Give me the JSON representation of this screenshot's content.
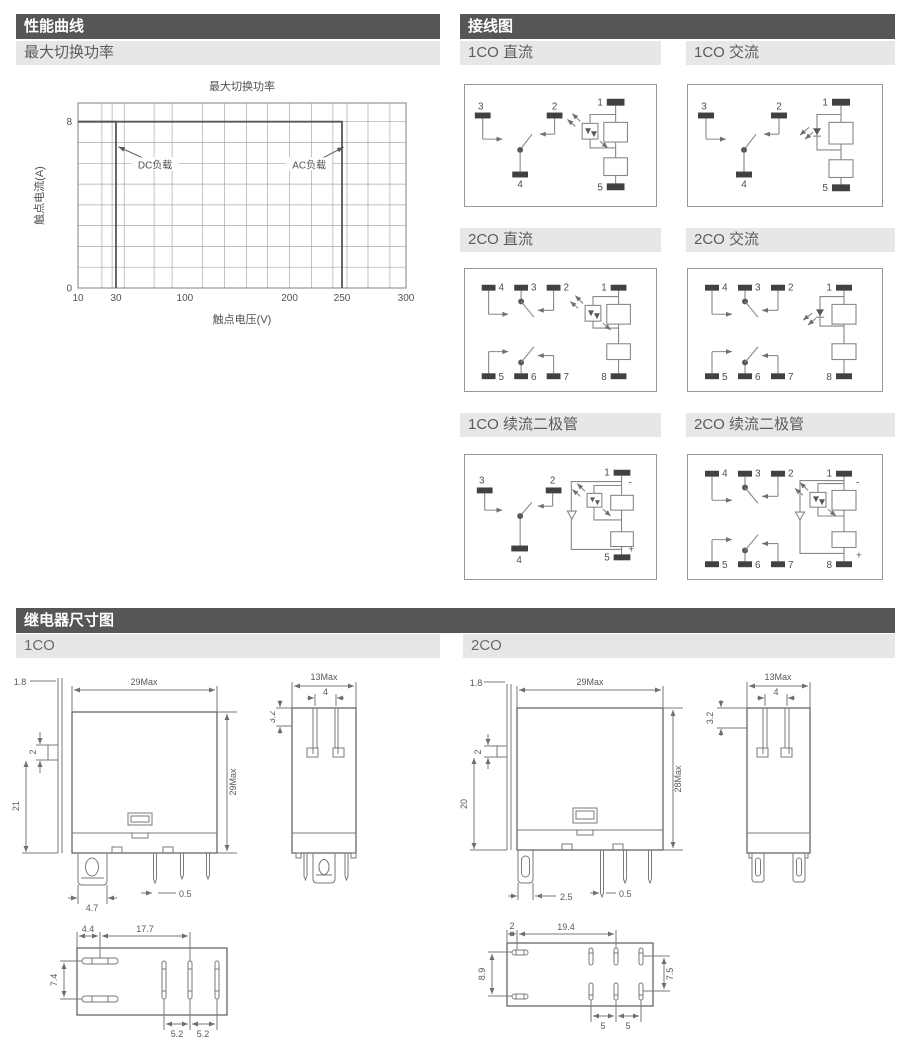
{
  "performance": {
    "header": "性能曲线",
    "subheader": "最大切换功率"
  },
  "chart_data": {
    "type": "line",
    "title": "最大切换功率",
    "xlabel": "触点电压(V)",
    "ylabel": "触点电流(A)",
    "x_ticks": [
      {
        "value": 10,
        "frac": 0
      },
      {
        "value": 30,
        "frac": 0.116
      },
      {
        "value": 100,
        "frac": 0.326
      },
      {
        "value": 200,
        "frac": 0.645
      },
      {
        "value": 250,
        "frac": 0.805
      },
      {
        "value": 300,
        "frac": 1
      }
    ],
    "x_gridline_fracs": [
      0,
      0.073,
      0.104,
      0.141,
      0.232,
      0.287,
      0.379,
      0.447,
      0.514,
      0.578,
      0.645,
      0.712,
      0.777,
      0.82,
      0.884,
      0.951,
      1
    ],
    "y_min": 0,
    "y_max": 8.9,
    "y_gridline_step": 1,
    "y_ticks": [
      0,
      8
    ],
    "grid": true,
    "series": [
      {
        "name": "DC负载",
        "points": [
          [
            10,
            8
          ],
          [
            30,
            8
          ],
          [
            30,
            0
          ]
        ]
      },
      {
        "name": "AC负载",
        "points": [
          [
            10,
            8
          ],
          [
            250,
            8
          ],
          [
            250,
            0
          ]
        ]
      }
    ],
    "annotations": [
      {
        "text": "DC负载",
        "text_frac_x": 0.235,
        "text_y": 5.9,
        "from_x": 0.205,
        "from_y": 6.2,
        "tip_x": 0.123,
        "tip_y": 6.8
      },
      {
        "text": "AC负载",
        "text_frac_x": 0.705,
        "text_y": 5.9,
        "from_x": 0.74,
        "from_y": 6.2,
        "tip_x": 0.81,
        "tip_y": 6.78
      }
    ]
  },
  "wiring": {
    "header": "接线图",
    "diagrams": [
      {
        "title": "1CO 直流",
        "terminals": {
          "t1": "1",
          "t2": "2",
          "t3": "3",
          "t4": "4",
          "t5": "5"
        }
      },
      {
        "title": "1CO 交流",
        "terminals": {
          "t1": "1",
          "t2": "2",
          "t3": "3",
          "t4": "4",
          "t5": "5"
        }
      },
      {
        "title": "2CO 直流",
        "terminals": {
          "t1": "1",
          "t2": "2",
          "t3": "3",
          "t4": "4",
          "t5": "5",
          "t6": "6",
          "t7": "7",
          "t8": "8"
        }
      },
      {
        "title": "2CO 交流",
        "terminals": {
          "t1": "1",
          "t2": "2",
          "t3": "3",
          "t4": "4",
          "t5": "5",
          "t6": "6",
          "t7": "7",
          "t8": "8"
        }
      },
      {
        "title": "1CO 续流二极管",
        "terminals": {
          "t1": "1",
          "t2": "2",
          "t3": "3",
          "t4": "4",
          "t5": "5"
        },
        "polarity": {
          "minus": "-",
          "plus": "+"
        }
      },
      {
        "title": "2CO 续流二极管",
        "terminals": {
          "t1": "1",
          "t2": "2",
          "t3": "3",
          "t4": "4",
          "t5": "5",
          "t6": "6",
          "t7": "7",
          "t8": "8"
        },
        "polarity": {
          "minus": "-",
          "plus": "+"
        }
      }
    ]
  },
  "dimensions": {
    "header": "继电器尺寸图",
    "one_co": {
      "label": "1CO",
      "front": {
        "flange": "1.8",
        "width": "29Max",
        "step": "2",
        "height_left": "21",
        "height_right": "29Max",
        "pin_wide": "4.7",
        "pin_thin": "0.5"
      },
      "side": {
        "width": "13Max",
        "prong_gap": "4",
        "notch": "3.2"
      },
      "bottom": {
        "offset": "4.4",
        "span": "17.7",
        "row_gap": "7.4",
        "pitch_a": "5.2",
        "pitch_b": "5.2"
      }
    },
    "two_co": {
      "label": "2CO",
      "front": {
        "flange": "1.8",
        "width": "29Max",
        "step": "2",
        "height_left": "20",
        "height_right": "28Max",
        "pin_wide": "2.5",
        "pin_thin": "0.5"
      },
      "side": {
        "width": "13Max",
        "prong_gap": "4",
        "notch": "3.2"
      },
      "bottom": {
        "offset": "2",
        "span": "19.4",
        "row_gap": "8.9",
        "col_height": "7.5",
        "pitch_a": "5",
        "pitch_b": "5"
      }
    }
  }
}
